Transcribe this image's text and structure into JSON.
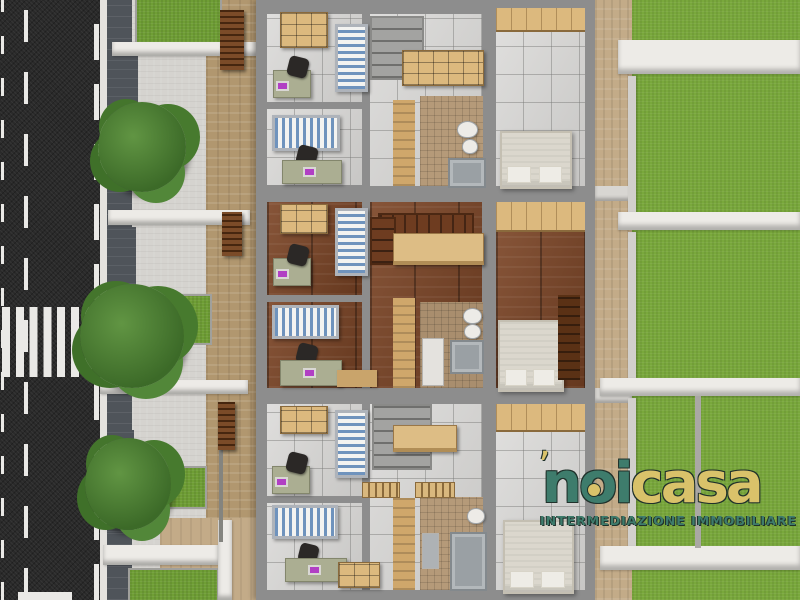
{
  "title": "3D top-down floor-plan rendering of three terraced houses",
  "logo": {
    "accent": "’",
    "brand_primary": "noi",
    "brand_secondary": "casa",
    "tagline": "INTERMEDIAZIONE IMMOBILIARE"
  },
  "palette": {
    "asphalt": "#2a2a2a",
    "road-marking": "#eae9e6",
    "paver": "#4f545a",
    "concrete": "#d5d3cf",
    "travertine": "#c3ab88",
    "travertine-dark": "#b1976f",
    "grass-front": "#6f9e35",
    "grass-back": "#79a83c",
    "tree": "#3c6a28",
    "wall-grey": "#8d8d8d",
    "wall-white": "#edebe7",
    "tile": "#d4d3d1",
    "wood-floor": "#7b4425",
    "mosaic": "#b59a79",
    "furniture-wood": "#dcb97e",
    "bed-stripe": "#6f93bd",
    "desk": "#abae92",
    "chair": "#2b2826",
    "laptop-screen": "#b13fc4",
    "master-bed": "#dbd7cd",
    "fixture": "#edebe7",
    "shower": "#9aa0a4",
    "stair": "#a3a3a1",
    "louver": "#7b4b28",
    "logo-teal": "#3e7c6c",
    "logo-gold": "#d9c26a",
    "logo-outline": "#20312b"
  },
  "scene": {
    "view": "top-down",
    "units": [
      {
        "name": "top unit",
        "floor_finish": "grey tile",
        "rooms": [
          "bedroom",
          "bedroom",
          "stair hall",
          "bathroom",
          "master bedroom",
          "rear terrace"
        ]
      },
      {
        "name": "middle unit",
        "floor_finish": "dark hardwood",
        "rooms": [
          "bedroom",
          "bedroom",
          "stair hall",
          "bathroom",
          "master bedroom",
          "rear terrace"
        ]
      },
      {
        "name": "bottom unit",
        "floor_finish": "grey tile",
        "rooms": [
          "bedroom",
          "bedroom",
          "stair hall",
          "bathroom",
          "master bedroom",
          "rear terrace"
        ]
      }
    ],
    "exterior": {
      "road": {
        "surface": "asphalt",
        "orientation": "vertical",
        "markings": [
          "left edge dashes",
          "center dashed line",
          "right edge dashed line",
          "zebra crosswalk",
          "stop bar"
        ]
      },
      "front": [
        "sidewalk curb",
        "dark paver strip",
        "concrete driveways",
        "lawn patches",
        "property walls",
        "trees",
        "pergola louvers",
        "travertine walkway"
      ],
      "rear": [
        "travertine terraces",
        "garden walls",
        "private lawns"
      ],
      "tree_count": 3,
      "front_lawn_count": 4,
      "rear_lawn_walls": 4
    }
  }
}
